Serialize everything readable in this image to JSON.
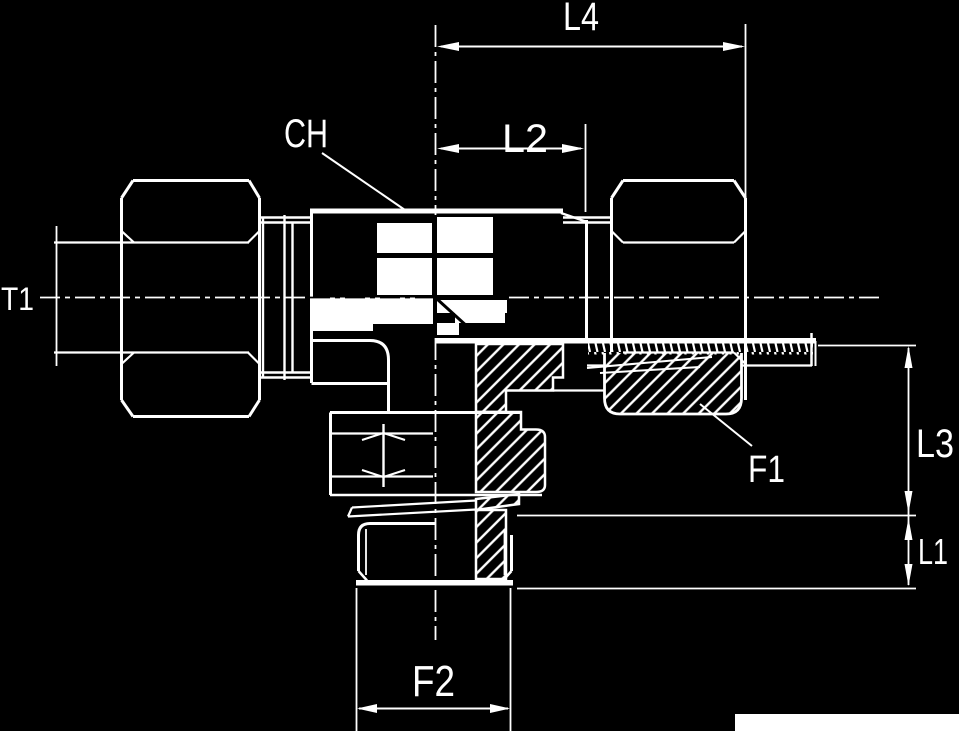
{
  "diagram": {
    "title": "Adjustable tee fitting technical drawing",
    "type": "technical-drawing",
    "colors": {
      "background": "#000000",
      "ink": "#ffffff"
    },
    "labels": {
      "l4": "L4",
      "l2": "L2",
      "ch": "CH",
      "t1": "T1",
      "l3": "L3",
      "l1": "L1",
      "f1": "F1",
      "f2": "F2"
    }
  }
}
